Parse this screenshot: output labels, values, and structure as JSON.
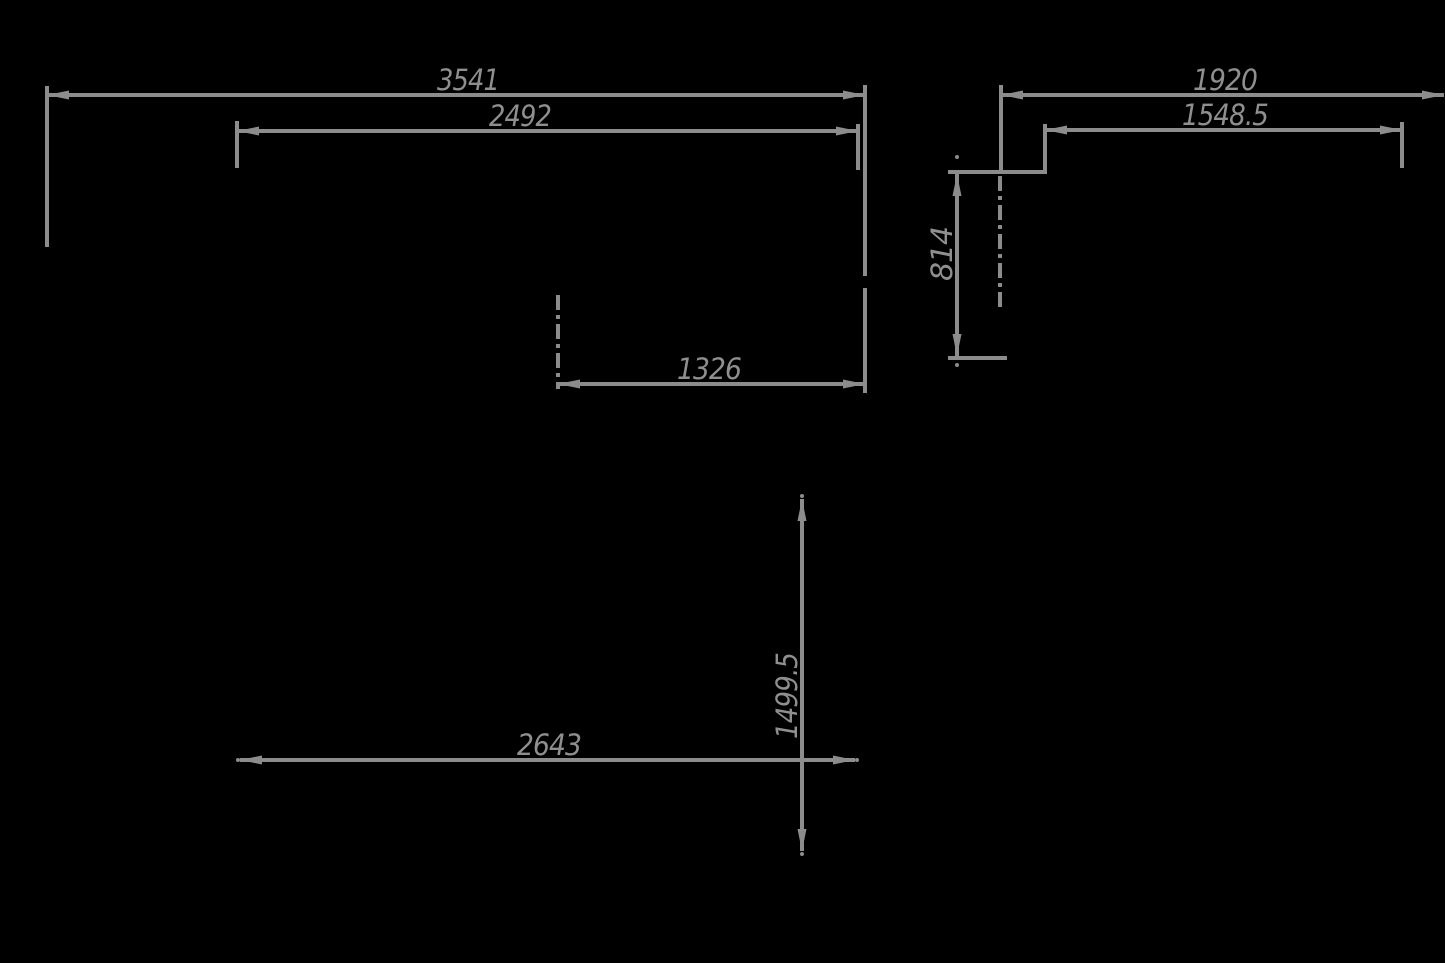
{
  "drawing": {
    "type": "cad-dimension-drawing",
    "background_color": "#000000",
    "line_color": "#8c8c8c",
    "text_color": "#8f8f8f",
    "views": {
      "plan": {
        "label": "plan-view",
        "dims": {
          "overall_width": "3541",
          "inner_width": "2492",
          "center_offset": "1326",
          "lower_width": "2643",
          "depth": "1499.5"
        }
      },
      "side": {
        "label": "side-view",
        "dims": {
          "overall_width": "1920",
          "inner_width": "1548.5",
          "height": "814"
        }
      }
    }
  }
}
